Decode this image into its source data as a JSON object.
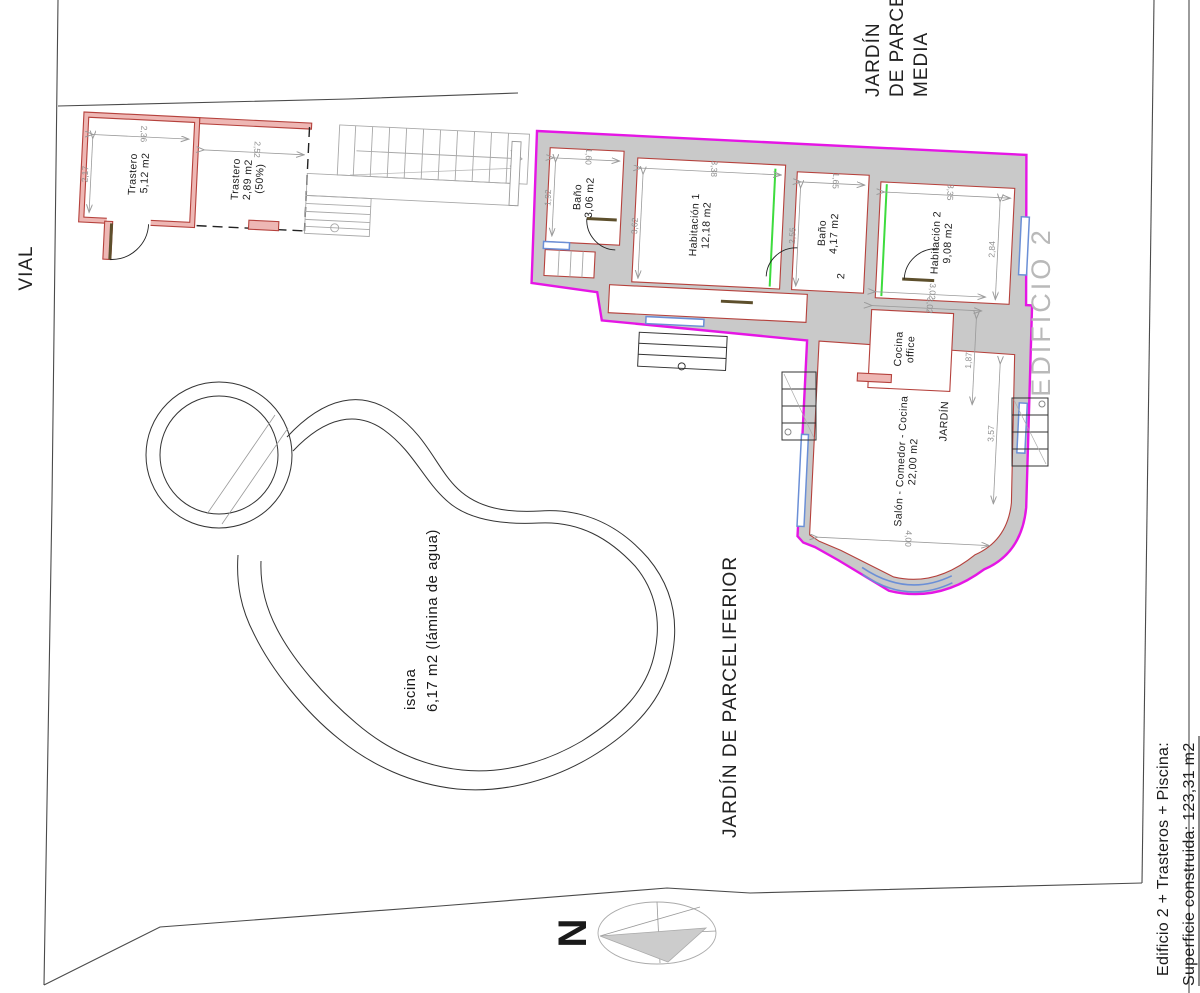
{
  "site": {
    "vial": "VIAL",
    "jardin_media_lines": [
      "JARDÍN",
      "DE PARCELA",
      "MEDIA"
    ],
    "jardin_inferior_line1": "JARDÍN DE PARCEL",
    "jardin_inferior_line2": "IFERIOR",
    "edificio_label": "EDIFICIO 2",
    "north": "N"
  },
  "pool": {
    "name": "iscina",
    "area": "6,17 m2 (lámina de agua)"
  },
  "trasteros": [
    {
      "name": "Trastero",
      "area": "5,12 m2",
      "note": ""
    },
    {
      "name": "Trastero",
      "area": "2,89 m2",
      "note": "(50%)"
    }
  ],
  "rooms": [
    {
      "name": "Baño",
      "area": "3,06 m2"
    },
    {
      "name": "Habitación 1",
      "area": "12,18 m2"
    },
    {
      "name": "Baño",
      "area": "4,17 m2"
    },
    {
      "name": "Habitación 2",
      "area": "9,08 m2"
    },
    {
      "name": "Cocina",
      "area": "office"
    },
    {
      "name": "Salón - Comedor - Cocina",
      "area": "22,00 m2"
    },
    {
      "name": "JARDÍN",
      "area": ""
    }
  ],
  "level_mark": "2",
  "dims": {
    "d236": "2,36",
    "d217": "2,17",
    "d252": "2,52",
    "d160": "1,60",
    "d192": "1,92",
    "d338": "3,38",
    "d362": "3,62",
    "d165": "1,65",
    "d255": "2,55",
    "d335": "3,35",
    "d284": "2,84",
    "d302a": "3,02",
    "d302b": "3,02",
    "d187": "1,87",
    "d357": "3,57",
    "d400": "4,00"
  },
  "summary": {
    "line1": "Edificio 2 + Trasteros + Piscina:",
    "line2": "Superficie construida: 123,31 m2",
    "line3": "Superficie útil: 61,55 m2"
  },
  "colors": {
    "building_outline": "#e516e5",
    "wall_fill": "#c9c9c9",
    "wall_red": "#b5413c",
    "window_blue": "#6b8fd6",
    "highlight_green": "#3ddc3d"
  }
}
